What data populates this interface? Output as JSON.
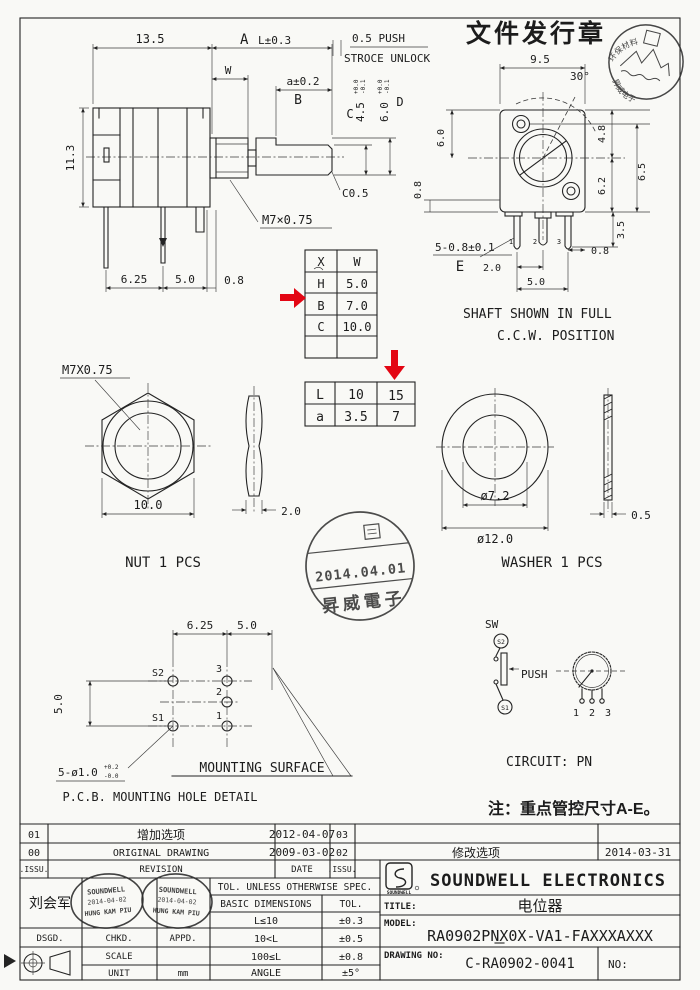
{
  "colors": {
    "ink": "#242424",
    "red_arrow": "#e30613",
    "paper": "#f9f9f6",
    "stamp": "#2e2e2e"
  },
  "header": {
    "doc_stamp": "文件发行章",
    "eco_top": "环保材料",
    "eco_bottom": "昇威电子"
  },
  "side_view": {
    "d135": "13.5",
    "d113": "11.3",
    "w": "W",
    "a_label": "A",
    "l_tol": "L±0.3",
    "a_tol": "a±0.2",
    "b_label": "B",
    "push1": "0.5 PUSH",
    "push2": "STROCE UNLOCK",
    "c_label": "C",
    "c_val": "4.5",
    "d_label": "D",
    "d_val": "6.0",
    "tol_p": "+0.0",
    "tol_m": "-0.1",
    "chamfer": "C0.5",
    "thread": "M7×0.75",
    "d625": "6.25",
    "d50": "5.0",
    "d08": "0.8"
  },
  "front_view": {
    "d95": "9.5",
    "ang": "30°",
    "d48": "4.8",
    "d62": "6.2",
    "d65": "6.5",
    "d35": "3.5",
    "d08r": "0.8",
    "d60": "6.0",
    "d08l": "0.8",
    "pins_dim": "5-0.8±0.1",
    "e_label": "E",
    "d20": "2.0",
    "d50": "5.0",
    "p1": "1",
    "p2": "2",
    "p3": "3",
    "cap1": "SHAFT SHOWN IN FULL",
    "cap2": "C.C.W. POSITION"
  },
  "option_table": {
    "h1": "X",
    "h2": "W",
    "rows": [
      [
        "H",
        "5.0"
      ],
      [
        "B",
        "7.0"
      ],
      [
        "C",
        "10.0"
      ]
    ]
  },
  "length_table": {
    "rows": [
      [
        "L",
        "10",
        "15"
      ],
      [
        "a",
        "3.5",
        "7"
      ]
    ]
  },
  "nut": {
    "thread": "M7X0.75",
    "d100": "10.0",
    "d20": "2.0",
    "caption": "NUT 1 PCS"
  },
  "washer": {
    "d_in": "ø7.2",
    "d_out": "ø12.0",
    "d_t": "0.5",
    "caption": "WASHER  1 PCS"
  },
  "date_stamp": {
    "date": "2014.04.01",
    "company": "昇威電子"
  },
  "pcb": {
    "d625": "6.25",
    "d50h": "5.0",
    "d50v": "5.0",
    "s2": "S2",
    "s1": "S1",
    "p1": "1",
    "p2": "2",
    "p3": "3",
    "holes": "5-ø1.0",
    "tol_p": "+0.2",
    "tol_m": "-0.0",
    "surface": "MOUNTING SURFACE",
    "caption": "P.C.B. MOUNTING HOLE DETAIL"
  },
  "circuit": {
    "sw": "SW",
    "s2": "S2",
    "s1": "S1",
    "push": "PUSH",
    "pins": "1 2 3",
    "caption": "CIRCUIT: PN"
  },
  "note": "注：重点管控尺寸A-E。",
  "title_block": {
    "revisions": [
      [
        "01",
        "增加选项",
        "2012-04-07",
        "03",
        "",
        ""
      ],
      [
        "00",
        "ORIGINAL DRAWING",
        "2009-03-02",
        "02",
        "修改选项",
        "2014-03-31"
      ]
    ],
    "issu": ".ISSU.",
    "revision": "REVISION",
    "date": "DATE",
    "issu2": ".ISSU.",
    "designer": "刘会军",
    "dsgd": "DSGD.",
    "chkd": "CHKD.",
    "appd": "APPD.",
    "scale": "SCALE",
    "unit": "UNIT",
    "mm": "mm",
    "stamp1": "SOUNDWELL",
    "stamp2": "2014-04-02",
    "stamp3": "HUNG KAM PIU",
    "tol_header": "TOL. UNLESS OTHERWISE SPEC.",
    "tol_c1": "BASIC DIMENSIONS",
    "tol_c2": "TOL.",
    "tol_rows": [
      [
        "L≤10",
        "±0.3"
      ],
      [
        "10<L",
        "±0.5"
      ],
      [
        "100≤L",
        "±0.8"
      ],
      [
        "ANGLE",
        "±5°"
      ]
    ],
    "logo": "SOUNDWELL",
    "company": "SOUNDWELL ELECTRONICS",
    "title_label": "TITLE:",
    "title_value": "电位器",
    "model_label": "MODEL:",
    "model_value": "RA0902PNX0X-VA1-FAXXXAXXX",
    "drawing_label": "DRAWING NO:",
    "drawing_value": "C-RA0902-0041",
    "no_label": "NO:"
  }
}
